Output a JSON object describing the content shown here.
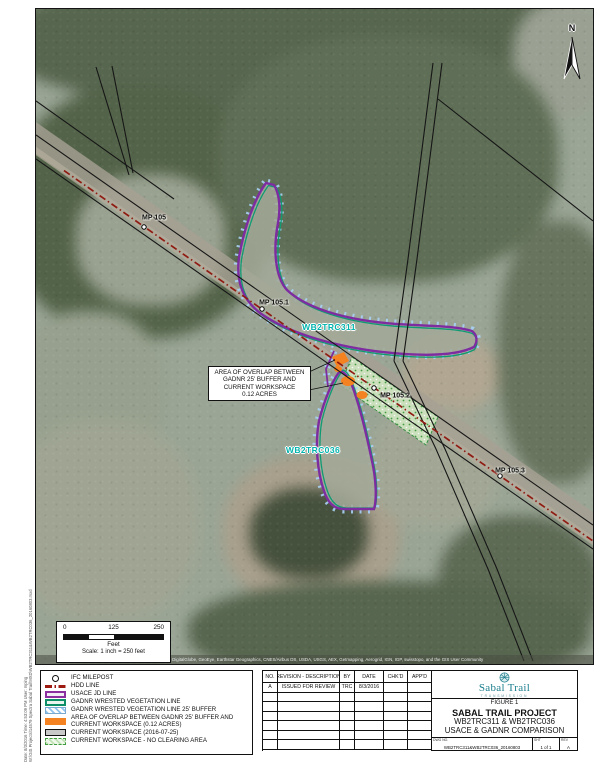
{
  "map": {
    "north_label": "N",
    "mileposts": [
      "MP 105",
      "MP 105.1",
      "MP 105.2",
      "MP 105.3"
    ],
    "wetland_labels": [
      "WB2TRC311",
      "WB2TRC036"
    ],
    "callout_lines": [
      "AREA OF OVERLAP BETWEEN",
      "GADNR 25' BUFFER AND",
      "CURRENT WORKSPACE",
      "0.12 ACRES"
    ],
    "scale_bar": {
      "tick_0": "0",
      "tick_mid": "125",
      "tick_max": "250",
      "unit": "Feet",
      "scale_text": "Scale: 1 inch = 250 feet"
    },
    "attribution": "Source: Esri, DigitalGlobe, GeoEye, Earthstar Geographics, CNES/Airbus DS, USDA, USGS, AEX, Getmapping, Aerogrid, IGN, IGP, swisstopo, and the GIS User Community",
    "plot_info_line1": "Date: 8/3/2016 Time: 4:53:09 PM User: mping",
    "plot_info_line2": "W:\\GIS Projects\\14579 Spectra Sabal Trail\\MXD\\WB2TRC311&WB2TRC036_20160803.mxd"
  },
  "legend": {
    "items": [
      {
        "label": "IFC MILEPOST",
        "swatch": "milepost"
      },
      {
        "label": "HDD LINE",
        "swatch": "hdd"
      },
      {
        "label": "USACE JD LINE",
        "swatch": "usace"
      },
      {
        "label": "GADNR WRESTED VEGETATION LINE",
        "swatch": "gadnr"
      },
      {
        "label": "GADNR WRESTED VEGETATION LINE 25' BUFFER",
        "swatch": "buffer"
      },
      {
        "label": "AREA OF OVERLAP BETWEEN GADNR 25' BUFFER AND CURRENT WORKSPACE (0.12 ACRES)",
        "swatch": "overlap"
      },
      {
        "label": "CURRENT WORKSPACE (2016-07-25)",
        "swatch": "workspace"
      },
      {
        "label": "CURRENT WORKSPACE - NO CLEARING AREA",
        "swatch": "noclear"
      }
    ]
  },
  "revision_table": {
    "headers": [
      "NO.",
      "REVISION - DESCRIPTION",
      "BY",
      "DATE",
      "CHK'D",
      "APP'D"
    ],
    "rows": [
      [
        "A",
        "ISSUED FOR REVIEW",
        "TRC",
        "8/3/2016",
        "",
        ""
      ]
    ],
    "empty_row_count": 6
  },
  "title_block": {
    "brand": "Sabal Trail",
    "brand_tagline": "TRANSMISSION",
    "figure_label": "FIGURE 1",
    "project": "SABAL TRAIL PROJECT",
    "subtitle_1": "WB2TRC311 & WB2TRC036",
    "subtitle_2": "USACE & GADNR COMPARISON",
    "dwg_label": "DWG NO.",
    "dwg_no": "WB2TRC311&WB2TRC036_20160803",
    "sheet_label": "SHT",
    "sheet": "1 of 1",
    "rev_label": "REV",
    "rev": "A"
  },
  "colors": {
    "usace_purple": "#8B2FA0",
    "gadnr_teal": "#0D8E66",
    "buffer_blue": "#8FC3EE",
    "overlap_orange": "#F58220",
    "hdd_red": "#9C1A10",
    "workspace_gray": "#C9C9C9",
    "noclear_green": "#3F9C3F",
    "wetland_label_teal": "#00B3AD",
    "brand_teal": "#1B7E8C"
  }
}
